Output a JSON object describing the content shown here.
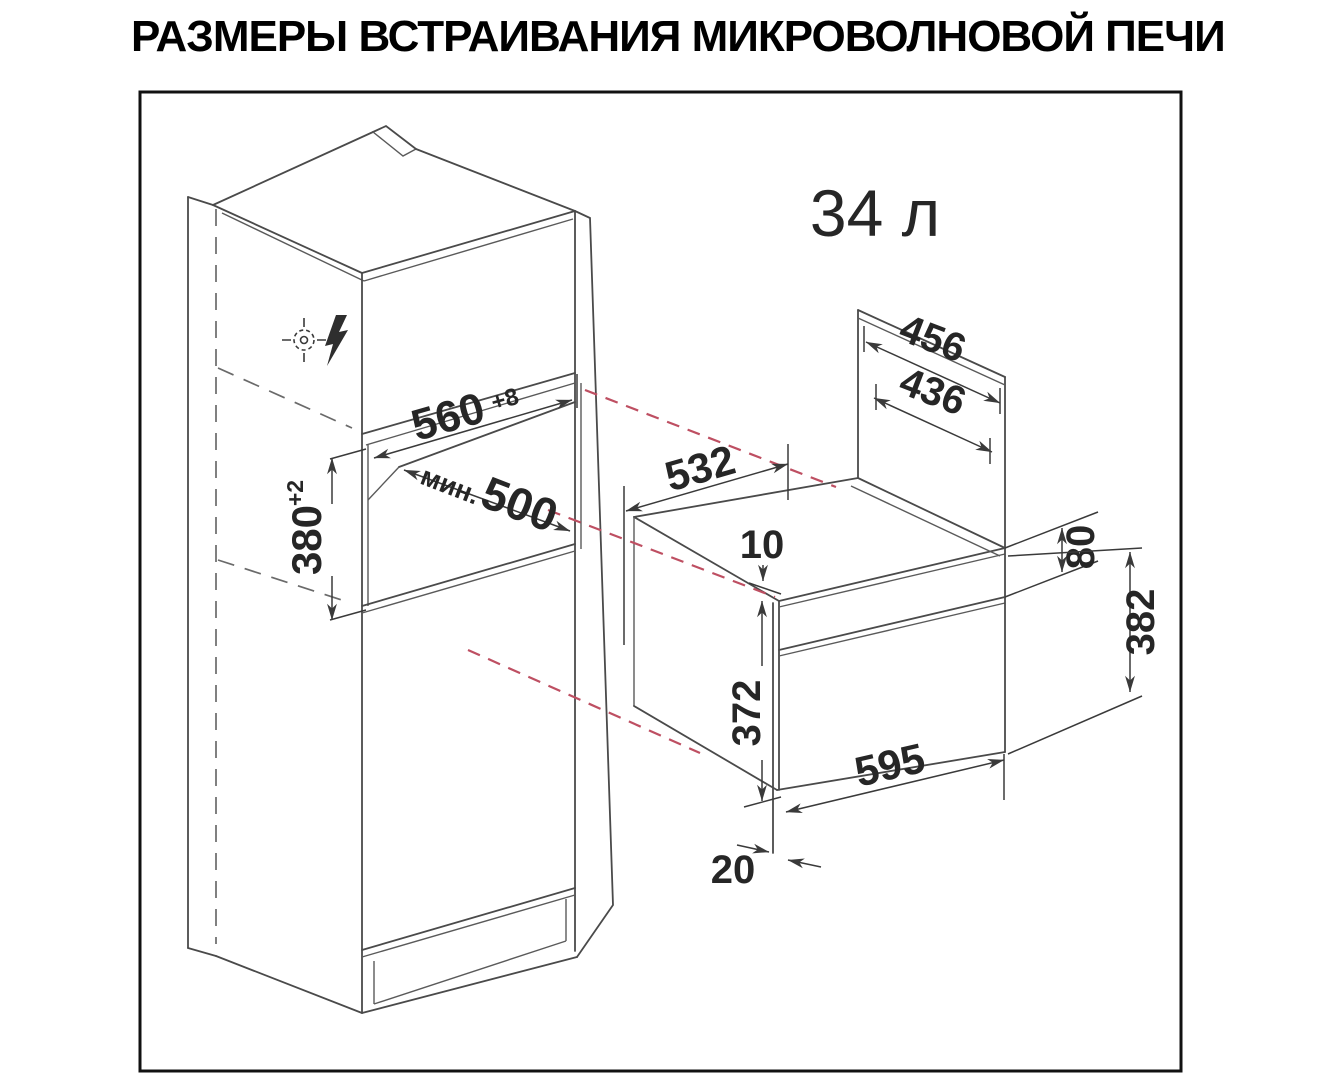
{
  "title": "РАЗМЕРЫ ВСТРАИВАНИЯ МИКРОВОЛНОВОЙ ПЕЧИ",
  "capacity": "34 л",
  "colors": {
    "accent_orange": "#ED6B1D",
    "drawing_line": "#4a4a4a",
    "dimension_text": "#262626",
    "red_dashed": "#BE4F62",
    "frame_border": "#111111",
    "background": "#FFFFFF"
  },
  "dims": {
    "niche_width": {
      "value": "560",
      "tol": "+8"
    },
    "niche_depth": {
      "prefix": "мин.",
      "value": "500"
    },
    "niche_height": {
      "value": "380",
      "tol": "+2"
    },
    "back_width": "456",
    "back_inner_width": "436",
    "body_depth": "532",
    "top_gap": "10",
    "control_panel_height": "80",
    "total_height": "382",
    "door_height": "372",
    "front_width": "595",
    "door_overhang": "20"
  },
  "icons": {
    "ground": "ground-fixing-symbol",
    "lightning": "lightning-bolt"
  }
}
